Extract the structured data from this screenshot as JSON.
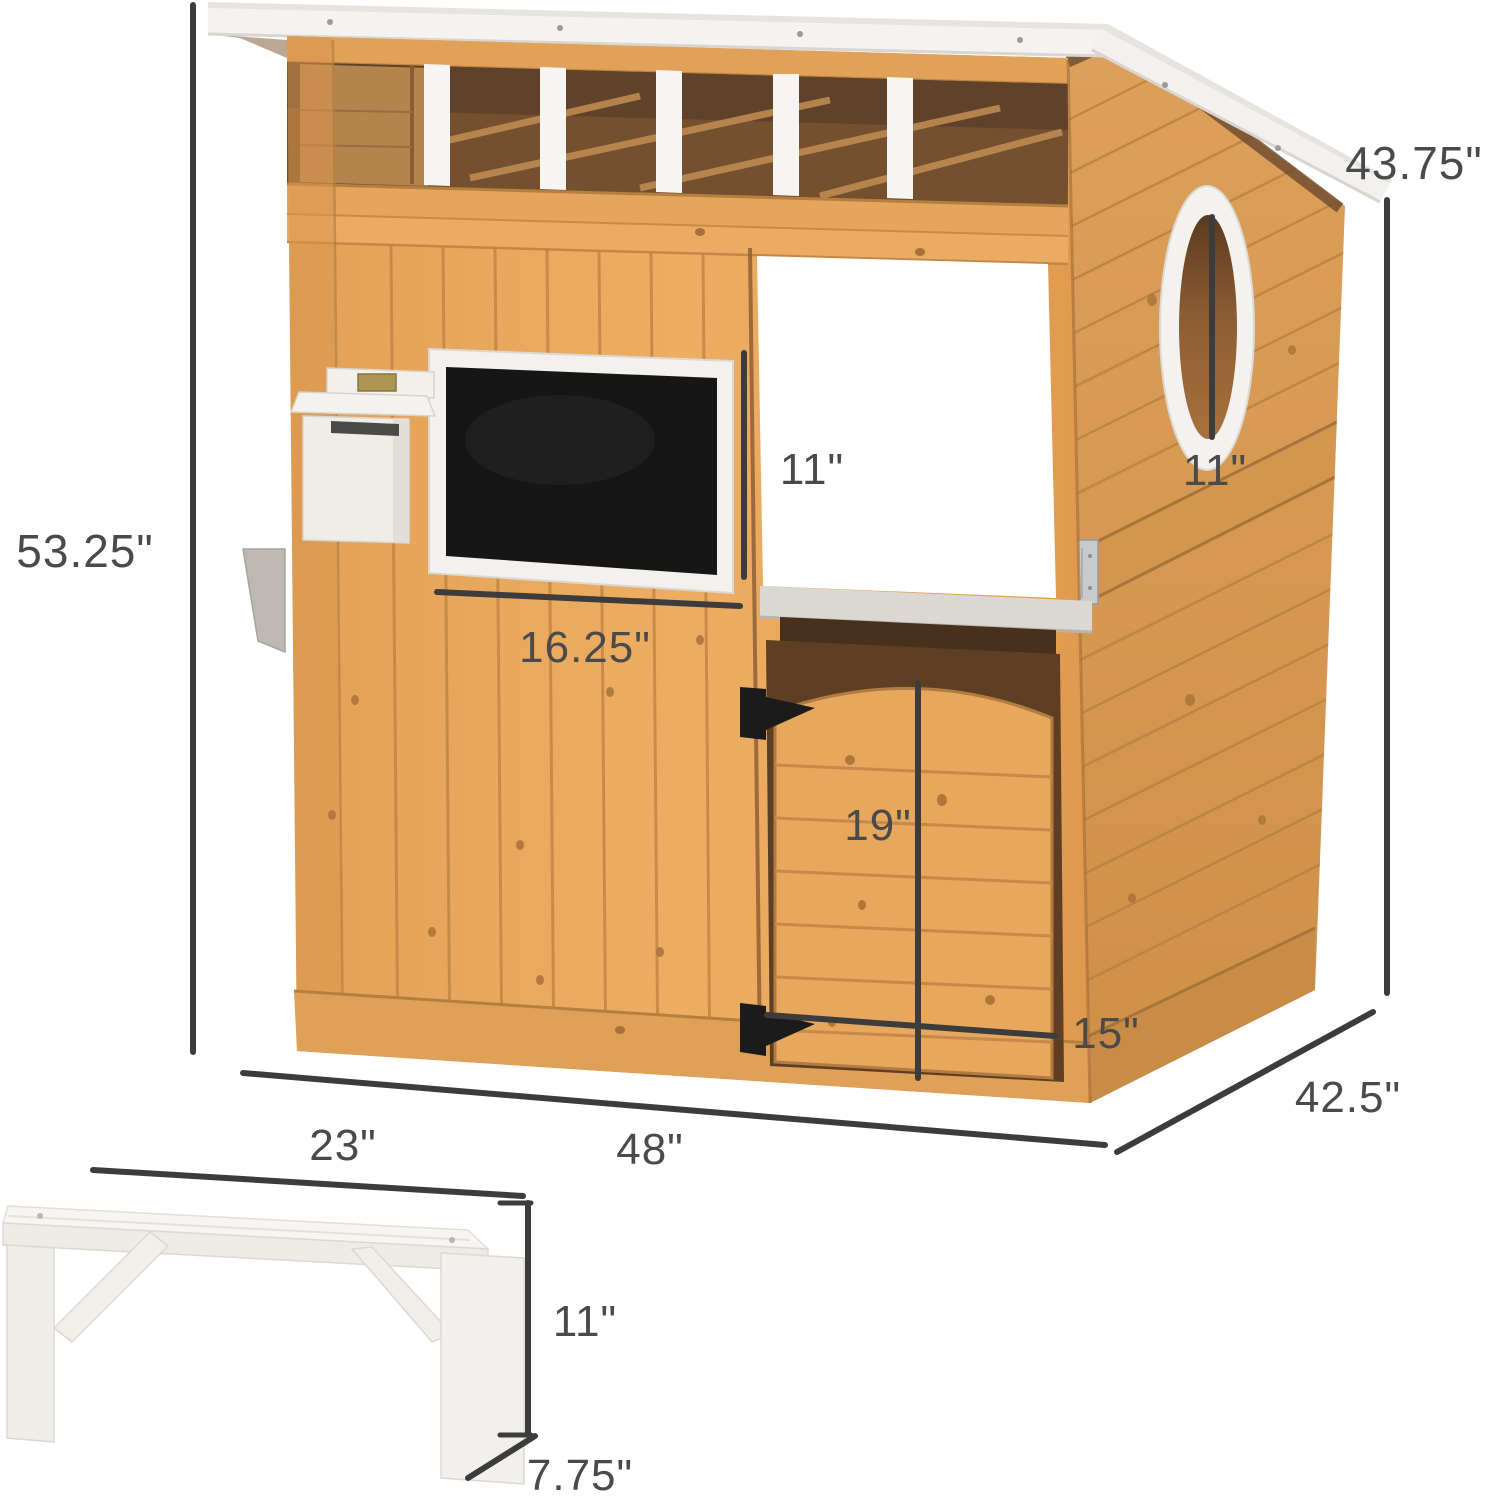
{
  "title": "Wooden outdoor playhouse with bench - dimension diagram",
  "dims": {
    "house_height": "53.25\"",
    "roof_side_height": "43.75\"",
    "door_window_height": "11\"",
    "oval_window_height": "11\"",
    "chalkboard_width": "16.25\"",
    "storage_door_height": "19\"",
    "storage_door_width": "15\"",
    "house_depth": "42.5\"",
    "house_width": "48\"",
    "bench_length": "23\"",
    "bench_height": "11\"",
    "bench_depth": "7.75\""
  },
  "colors": {
    "wood": "#E8A85C",
    "wood_dark": "#C98B44",
    "roof_white": "#F4F3F0",
    "interior_brown": "#5E402A",
    "chalkboard_black": "#161616",
    "hardware_black": "#1B1B1B",
    "metal_silver": "#C9CACB",
    "dimension_line": "#3C3C3C",
    "label_text": "#4A4A4A"
  }
}
